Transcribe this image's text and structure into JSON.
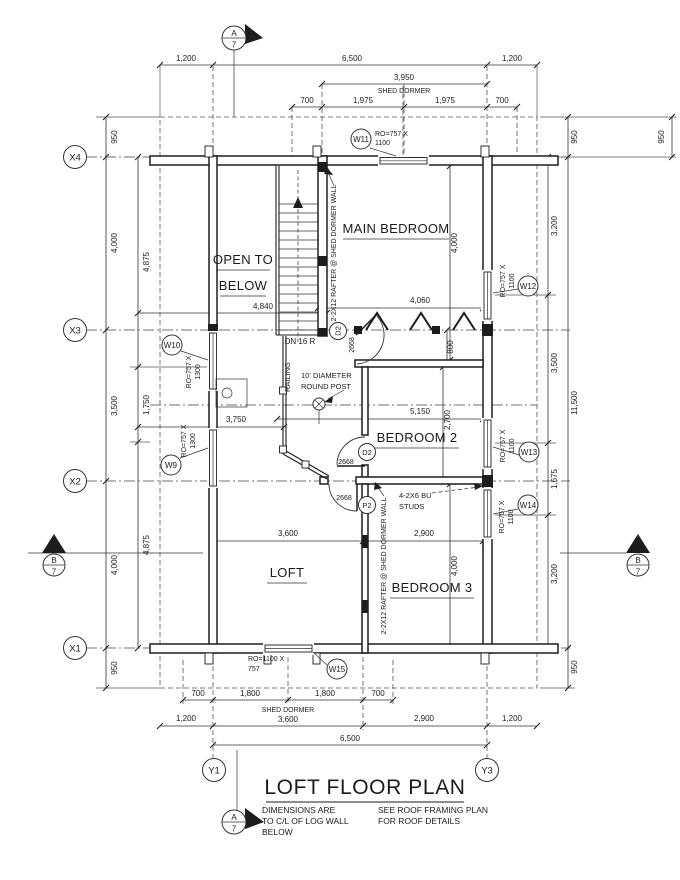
{
  "title": {
    "text": "LOFT FLOOR PLAN"
  },
  "notes": {
    "dims_l1": "DIMENSIONS ARE",
    "dims_l2": "TO C/L OF LOG WALL",
    "dims_l3": "BELOW",
    "roof_l1": "SEE ROOF FRAMING PLAN",
    "roof_l2": "FOR ROOF DETAILS"
  },
  "rooms": {
    "main_bedroom": "MAIN BEDROOM",
    "open_to_l1": "OPEN TO",
    "open_to_l2": "BELOW",
    "bedroom2": "BEDROOM 2",
    "loft": "LOFT",
    "bedroom3": "BEDROOM 3"
  },
  "grid": {
    "x4": "X4",
    "x3": "X3",
    "x2": "X2",
    "x1": "X1",
    "y1": "Y1",
    "y3": "Y3"
  },
  "sections": {
    "a": "A",
    "b": "B",
    "sheet": "7"
  },
  "dims": {
    "top": {
      "left_1200": "1,200",
      "total_6500": "6,500",
      "right_1200": "1,200",
      "dormer_3950": "3,950",
      "shed_dormer": "SHED DORMER",
      "s700a": "700",
      "s1975a": "1,975",
      "s1975b": "1,975",
      "s700b": "700"
    },
    "left": {
      "eave_950": "950",
      "x43_4000": "4,000",
      "x32_3500": "3,500",
      "x21_4000": "4,000",
      "eaveb_950": "950",
      "upper_4875": "4,875",
      "mid_1750": "1,750",
      "lower_4875": "4,875"
    },
    "right": {
      "eave_950": "950",
      "seg_3200a": "3,200",
      "seg_3500": "3,500",
      "seg_1675": "1,675",
      "seg_3200b": "3,200",
      "eaveb_950": "950",
      "total_11500": "11,500",
      "edge_950": "950"
    },
    "bottom": {
      "s700a": "700",
      "s1800a": "1,800",
      "s1800b": "1,800",
      "s700b": "700",
      "left_1200": "1,200",
      "shed_dormer": "SHED DORMER",
      "loft_3600": "3,600",
      "bed3_2900": "2,900",
      "right_1200": "1,200",
      "total_6500": "6,500"
    },
    "interior": {
      "stair_4840": "4,840",
      "loft_3750": "3,750",
      "open_5150": "5,150",
      "mb_4060": "4,060",
      "mb_4000": "4,000",
      "mb_800": "800",
      "b2_2700": "2,700",
      "loft_3600": "3,600",
      "b3_2900": "2,900",
      "b3_4000": "4,000"
    }
  },
  "windows": {
    "w9": {
      "label": "W9",
      "ro1": "RO=757 X",
      "ro2": "1300"
    },
    "w10": {
      "label": "W10",
      "ro1": "RO=757 X",
      "ro2": "1300"
    },
    "w11": {
      "label": "W11",
      "ro1": "RO=757 X",
      "ro2": "1100"
    },
    "w12": {
      "label": "W12",
      "ro1": "RO=757 X",
      "ro2": "1100"
    },
    "w13": {
      "label": "W13",
      "ro1": "RO=757 X",
      "ro2": "1100"
    },
    "w14": {
      "label": "W14",
      "ro1": "RO=757 X",
      "ro2": "1100"
    },
    "w15": {
      "label": "W15",
      "ro1": "RO=1100 X",
      "ro2": "757"
    }
  },
  "doors": {
    "d2_main": {
      "label": "D2",
      "size": "2668"
    },
    "d2_bed2": {
      "label": "D2",
      "size": "2668"
    },
    "p2": {
      "label": "P2",
      "size": "2668"
    }
  },
  "annotations": {
    "down": "DN 16 R",
    "railing": "RAILING",
    "post_l1": "10' DIAMETER",
    "post_l2": "ROUND POST",
    "rafter": "2-2X12 RAFTER @ SHED DORMER WALL",
    "studs_l1": "4-2X6 BU",
    "studs_l2": "STUDS"
  }
}
